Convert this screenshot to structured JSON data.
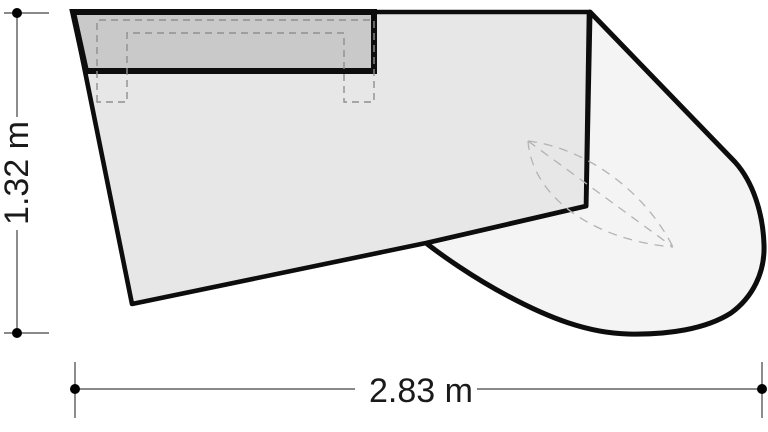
{
  "dimensions": {
    "width": {
      "label": "2.83 m"
    },
    "height": {
      "label": "1.32 m"
    }
  },
  "colors": {
    "background": "#ffffff",
    "outline": "#0d0d0d",
    "body_fill": "#e7e7e7",
    "top_band_fill": "#c9c9c9",
    "curved_section_fill": "#f4f4f4",
    "hidden_frame_line": "#8f8f8f",
    "hidden_ellipse_line": "#b3b3b3",
    "dimension_line": "#787878",
    "dimension_dot": "#000000",
    "text": "#1a1a1a"
  }
}
